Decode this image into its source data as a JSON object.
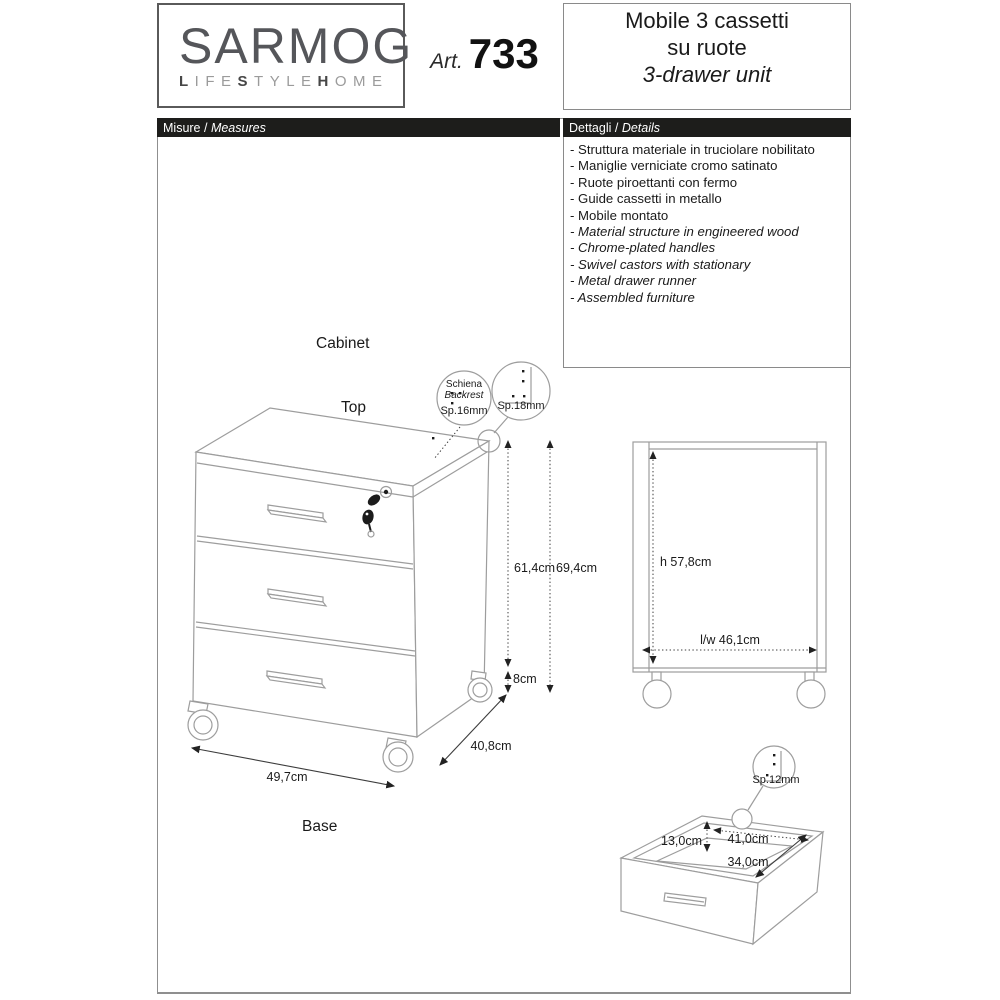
{
  "header": {
    "logo": {
      "brand": "SARMOG",
      "tagline": {
        "b1": "L",
        "t1": "IFE",
        "b2": "S",
        "t2": "TYLE",
        "b3": "H",
        "t3": "OME"
      }
    },
    "article": {
      "label": "Art.",
      "number": "733"
    },
    "title": {
      "line1_it": "Mobile 3 cassetti",
      "line2_it": "su ruote",
      "line_en": "3-drawer unit"
    }
  },
  "section_bars": {
    "measures": {
      "it": "Misure",
      "sep": " / ",
      "en": "Measures"
    },
    "details": {
      "it": "Dettagli",
      "sep": " / ",
      "en": "Details"
    }
  },
  "details_list": {
    "items_it": [
      "- Struttura materiale in truciolare nobilitato",
      "- Maniglie verniciate cromo satinato",
      "- Ruote piroettanti con fermo",
      "- Guide cassetti in metallo",
      "- Mobile montato"
    ],
    "items_en": [
      "- Material structure in engineered wood",
      "- Chrome-plated handles",
      "- Swivel castors with stationary",
      "- Metal drawer runner",
      "- Assembled furniture"
    ]
  },
  "diagram": {
    "labels": {
      "cabinet": "Cabinet",
      "top": "Top",
      "base": "Base"
    },
    "callouts": {
      "backrest": {
        "line1": "Schiena",
        "line2": "Backrest",
        "thickness": "Sp.16mm"
      },
      "top_panel": {
        "thickness": "Sp.18mm"
      },
      "drawer_panel": {
        "thickness": "Sp.12mm"
      }
    },
    "dimensions": {
      "cabinet_body_height": "61,4cm",
      "cabinet_total_height": "69,4cm",
      "caster_height": "8cm",
      "cabinet_width": "49,7cm",
      "cabinet_depth": "40,8cm",
      "interior_height": "h 57,8cm",
      "interior_width": "l/w 46,1cm",
      "drawer_inner_height": "13,0cm",
      "drawer_inner_width": "41,0cm",
      "drawer_inner_depth": "34,0cm"
    }
  }
}
